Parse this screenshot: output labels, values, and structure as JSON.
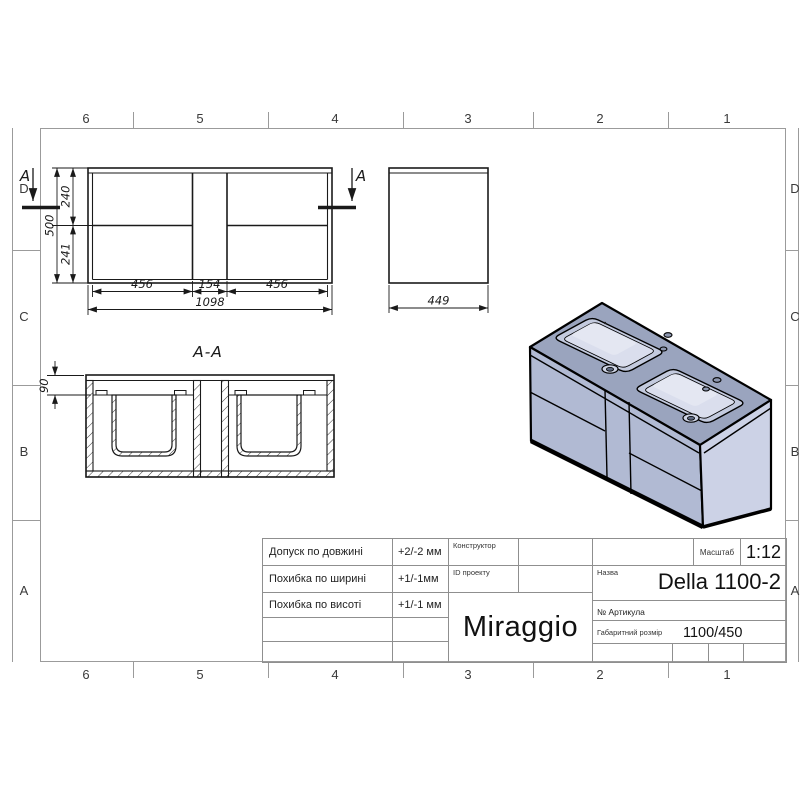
{
  "sheet": {
    "grid_columns": [
      "6",
      "5",
      "4",
      "3",
      "2",
      "1"
    ],
    "grid_rows": [
      "D",
      "C",
      "B",
      "A"
    ]
  },
  "views": {
    "front": {
      "section_marker": "A",
      "dim_height_top": "240",
      "dim_height_total": "500",
      "dim_height_bottom": "241",
      "dim_width_left": "456",
      "dim_width_middle": "154",
      "dim_width_right": "456",
      "dim_width_total": "1098"
    },
    "side": {
      "dim_depth": "449"
    },
    "section": {
      "title": "A-A",
      "dim_basin_depth": "90"
    }
  },
  "title_block": {
    "tolerances": [
      {
        "label": "Допуск по довжині",
        "value": "+2/-2 мм"
      },
      {
        "label": "Похибка по ширині",
        "value": "+1/-1мм"
      },
      {
        "label": "Похибка по висоті",
        "value": "+1/-1 мм"
      }
    ],
    "designer_label": "Конструктор",
    "project_id_label": "ID проекту",
    "brand": "Miraggio",
    "scale_label": "Масштаб",
    "scale_value": "1:12",
    "name_label": "Назва",
    "product_name": "Della 1100-2",
    "article_label": "№  Артикула",
    "overall_size_label": "Габаритний розмір",
    "overall_size_value": "1100/450"
  },
  "colors": {
    "line": "#1a1a1a",
    "frame": "#9b9b9b",
    "iso_top": "#9aa4be",
    "iso_front": "#b1bad3",
    "iso_side": "#ccd2e6",
    "basin_rim": "#c3cade",
    "basin_inner": "#dadeed",
    "basin_highlight": "#e4e7f2"
  }
}
